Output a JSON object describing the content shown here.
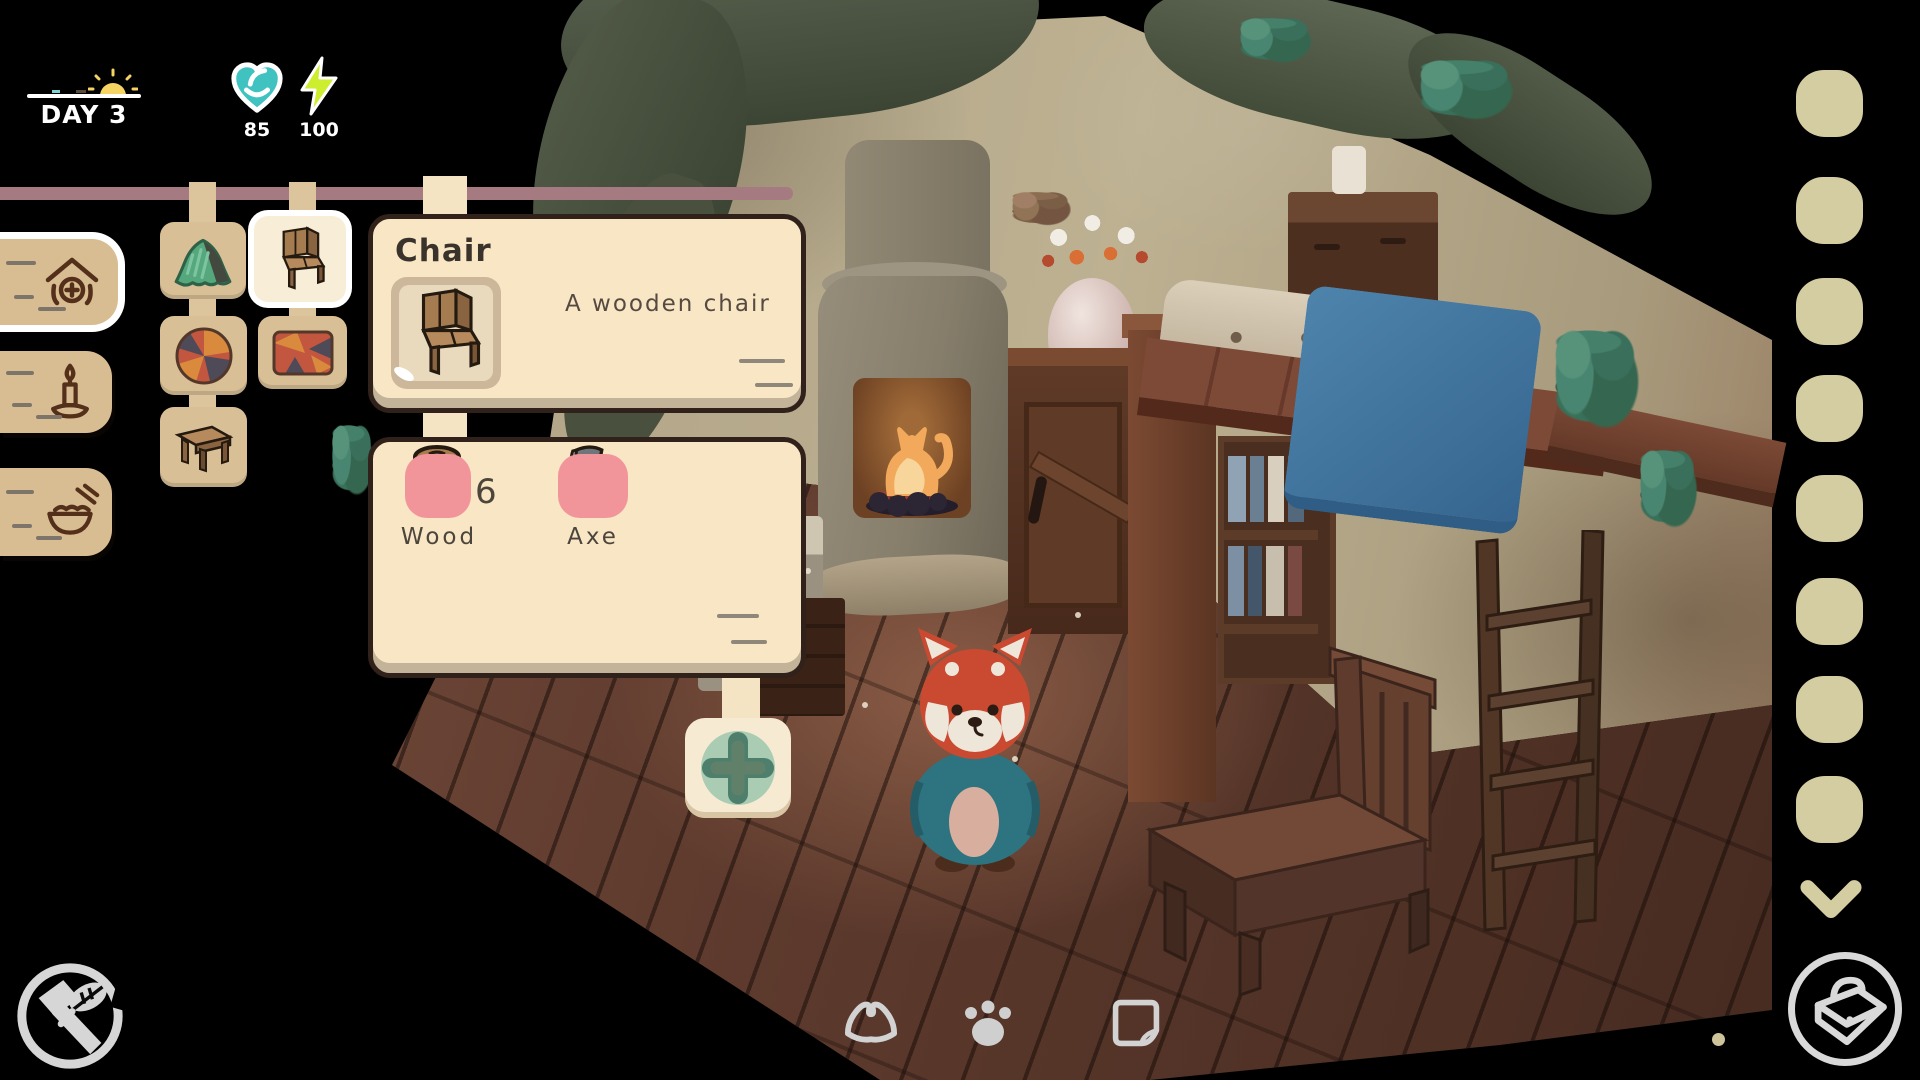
{
  "hud": {
    "day_label": "DAY 3",
    "hearts": "85",
    "energy": "100"
  },
  "colors": {
    "panel_cream": "#f8e6c5",
    "bar_mauve": "#a57a80",
    "category_tan": "#d9bf96",
    "requirement_pink": "#f2959b",
    "slot_khaki": "#d4cda1",
    "heart_teal": "#3fc2c0",
    "energy_lime": "#cdee2e",
    "plus_green": "#a9ccb3"
  },
  "sidebar": {
    "tabs": [
      {
        "id": "build",
        "icon": "house-plus-icon",
        "selected": true
      },
      {
        "id": "lighting",
        "icon": "candle-icon",
        "selected": false
      },
      {
        "id": "food",
        "icon": "food-bowl-icon",
        "selected": false
      }
    ]
  },
  "categories": [
    {
      "id": "tent",
      "icon": "tent-icon",
      "selected": false
    },
    {
      "id": "chair",
      "icon": "chair-icon",
      "selected": true
    },
    {
      "id": "round-rug",
      "icon": "round-rug-icon",
      "selected": false
    },
    {
      "id": "rect-rug",
      "icon": "rect-rug-icon",
      "selected": false
    },
    {
      "id": "table",
      "icon": "table-icon",
      "selected": false
    }
  ],
  "recipe": {
    "title": "Chair",
    "description": "A wooden chair",
    "requirements": [
      {
        "name": "Wood",
        "count": "6",
        "icon": "log-icon"
      },
      {
        "name": "Axe",
        "count": "",
        "icon": "axe-icon"
      }
    ]
  },
  "right_rail": {
    "slot_count": 8,
    "more_icon": "chevron-down-icon"
  },
  "footer": {
    "left_icon": "crafting-tools-icon",
    "center_icons": [
      "tent-mode-icon",
      "paw-mode-icon",
      "paper-mode-icon"
    ],
    "right_icon": "bag-icon"
  }
}
